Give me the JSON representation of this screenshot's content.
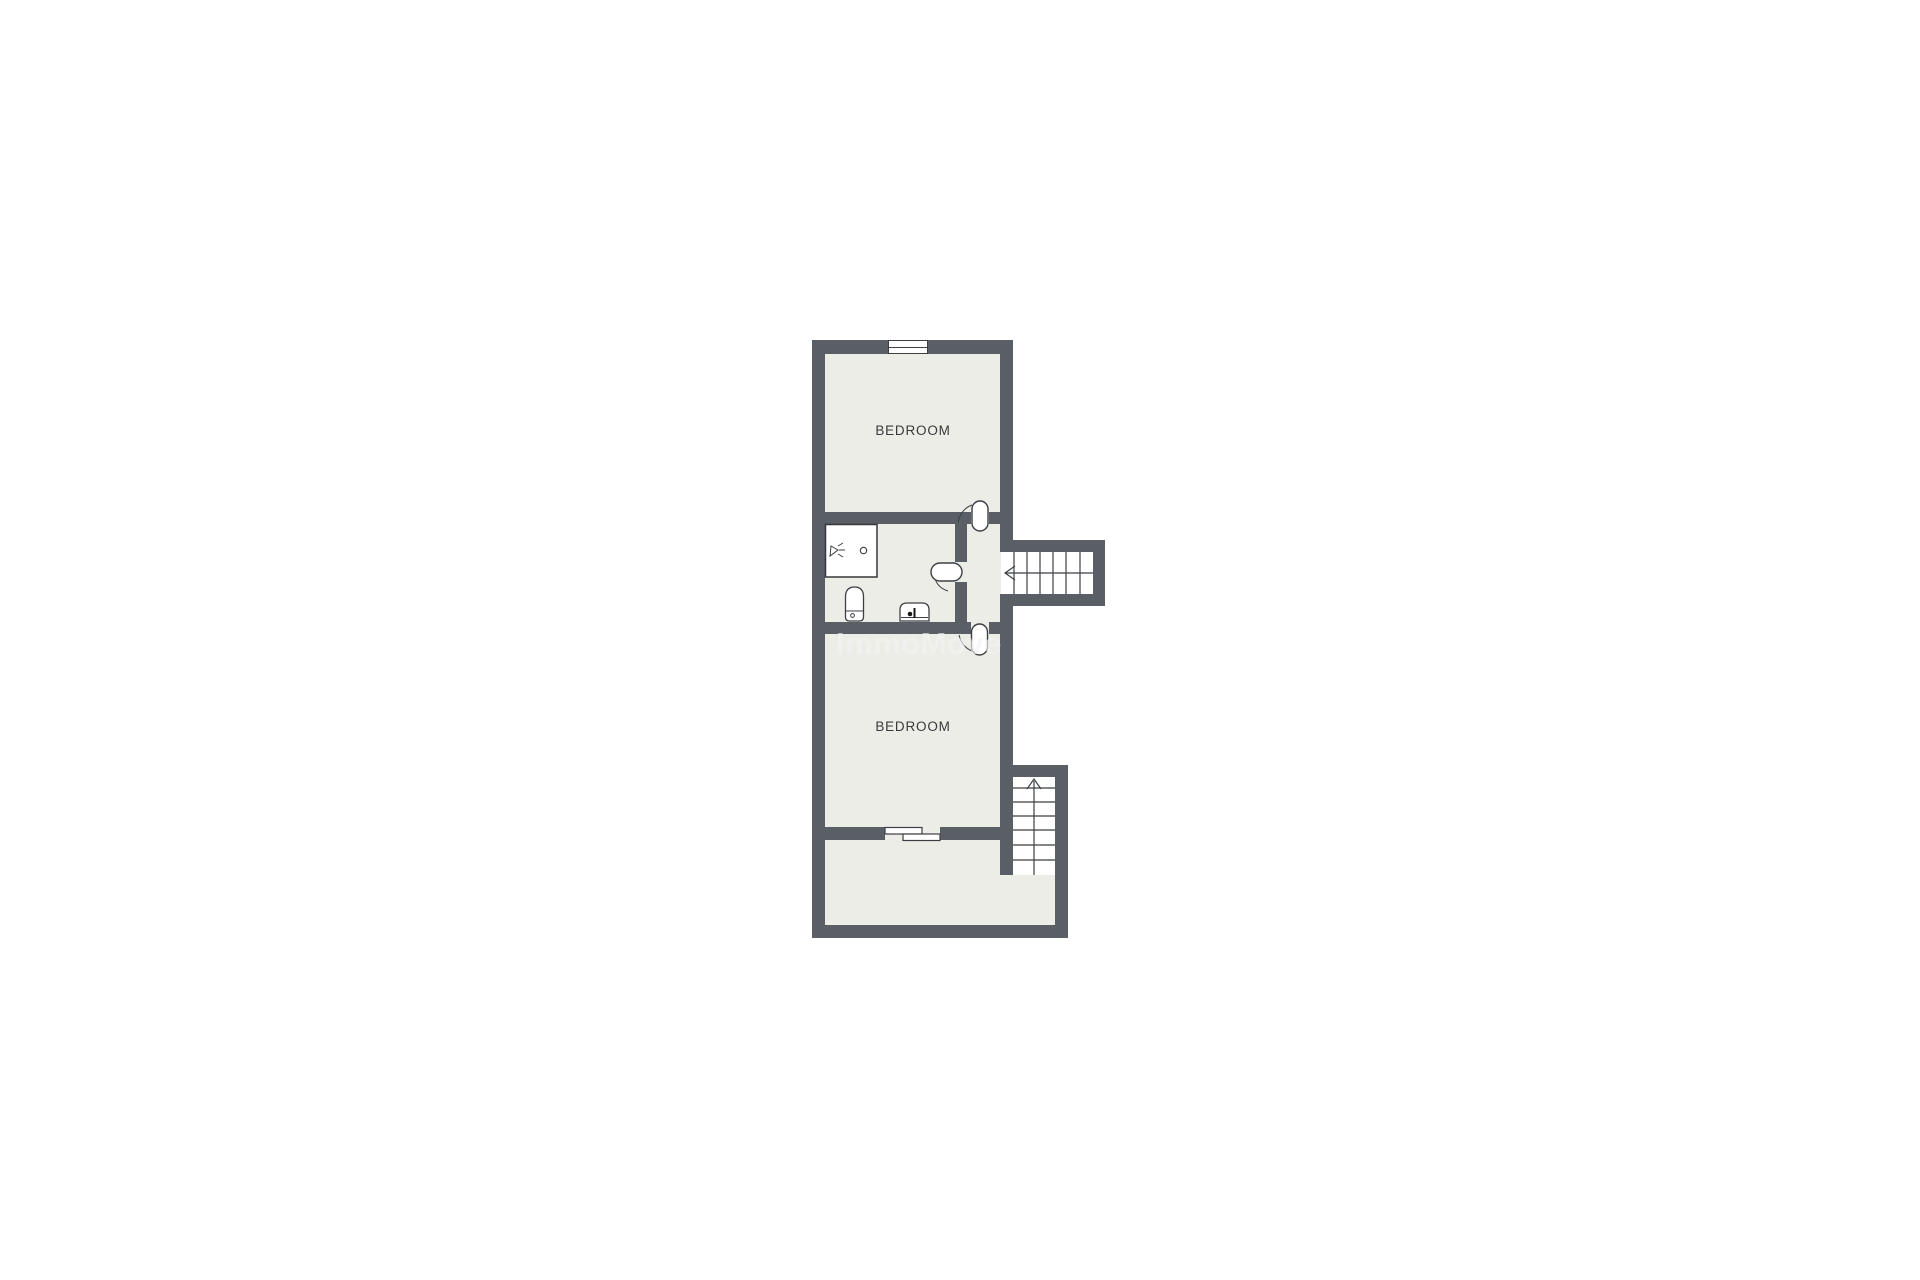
{
  "floorplan": {
    "watermark": "ImmoMove",
    "colors": {
      "wall": "#5a5e65",
      "floor": "#ecede6",
      "line": "#3c3f45",
      "label_text": "#3a3a3d",
      "watermark_text": "rgba(242,242,242,0.65)"
    },
    "rooms": [
      {
        "id": "bedroom-1",
        "label": "BEDROOM"
      },
      {
        "id": "bathroom",
        "label": ""
      },
      {
        "id": "hallway",
        "label": ""
      },
      {
        "id": "bedroom-2",
        "label": "BEDROOM"
      },
      {
        "id": "bottom-room",
        "label": ""
      }
    ],
    "features": {
      "window_count": 1,
      "stairs": [
        {
          "id": "stairs-upper-right",
          "direction": "left",
          "treads": 7
        },
        {
          "id": "stairs-lower-right",
          "direction": "up",
          "treads": 7
        }
      ],
      "doors": [
        {
          "id": "door-bedroom-1",
          "type": "swing"
        },
        {
          "id": "door-bathroom",
          "type": "swing"
        },
        {
          "id": "door-bedroom-2",
          "type": "swing"
        },
        {
          "id": "door-sliding-bottom-room",
          "type": "sliding"
        }
      ],
      "fixtures": [
        "shower",
        "toilet",
        "sink"
      ]
    }
  }
}
